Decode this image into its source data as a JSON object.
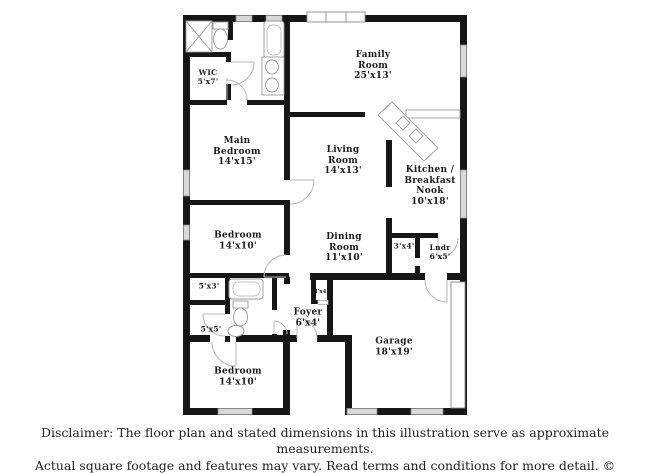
{
  "plan": {
    "brand": "PlanOmatic",
    "wall_color": "#161616",
    "window_color": "#d8d8d8",
    "door_arc_color": "#b8b8b8",
    "rooms": [
      {
        "id": "wic",
        "lines": [
          "WIC",
          "5'x7'"
        ]
      },
      {
        "id": "family-room",
        "lines": [
          "Family",
          "Room",
          "25'x13'"
        ]
      },
      {
        "id": "main-bedroom",
        "lines": [
          "Main",
          "Bedroom",
          "14'x15'"
        ]
      },
      {
        "id": "living-room",
        "lines": [
          "Living",
          "Room",
          "14'x13'"
        ]
      },
      {
        "id": "kitchen-breakfast-nook",
        "lines": [
          "Kitchen /",
          "Breakfast",
          "Nook",
          "10'x18'"
        ]
      },
      {
        "id": "bedroom-2",
        "lines": [
          "Bedroom",
          "14'x10'"
        ]
      },
      {
        "id": "dining-room",
        "lines": [
          "Dining",
          "Room",
          "11'x10'"
        ]
      },
      {
        "id": "hall-closet-3x4",
        "lines": [
          "3'x4'"
        ]
      },
      {
        "id": "laundry",
        "lines": [
          "Lndr",
          "6'x5'"
        ]
      },
      {
        "id": "closet-5x3",
        "lines": [
          "5'x3'"
        ]
      },
      {
        "id": "closet-5x5",
        "lines": [
          "5'x5'"
        ]
      },
      {
        "id": "closet-4x4",
        "lines": [
          "4'x4'"
        ]
      },
      {
        "id": "foyer",
        "lines": [
          "Foyer",
          "6'x4'"
        ]
      },
      {
        "id": "garage",
        "lines": [
          "Garage",
          "18'x19'"
        ]
      },
      {
        "id": "bedroom-3",
        "lines": [
          "Bedroom",
          "14'x10'"
        ]
      }
    ]
  },
  "disclaimer": {
    "line1": "Disclaimer: The floor plan and stated dimensions in this illustration serve as approximate measurements.",
    "line2": "Actual square footage and features may vary. Read terms and conditions for more detail. © PlanOmatic"
  }
}
